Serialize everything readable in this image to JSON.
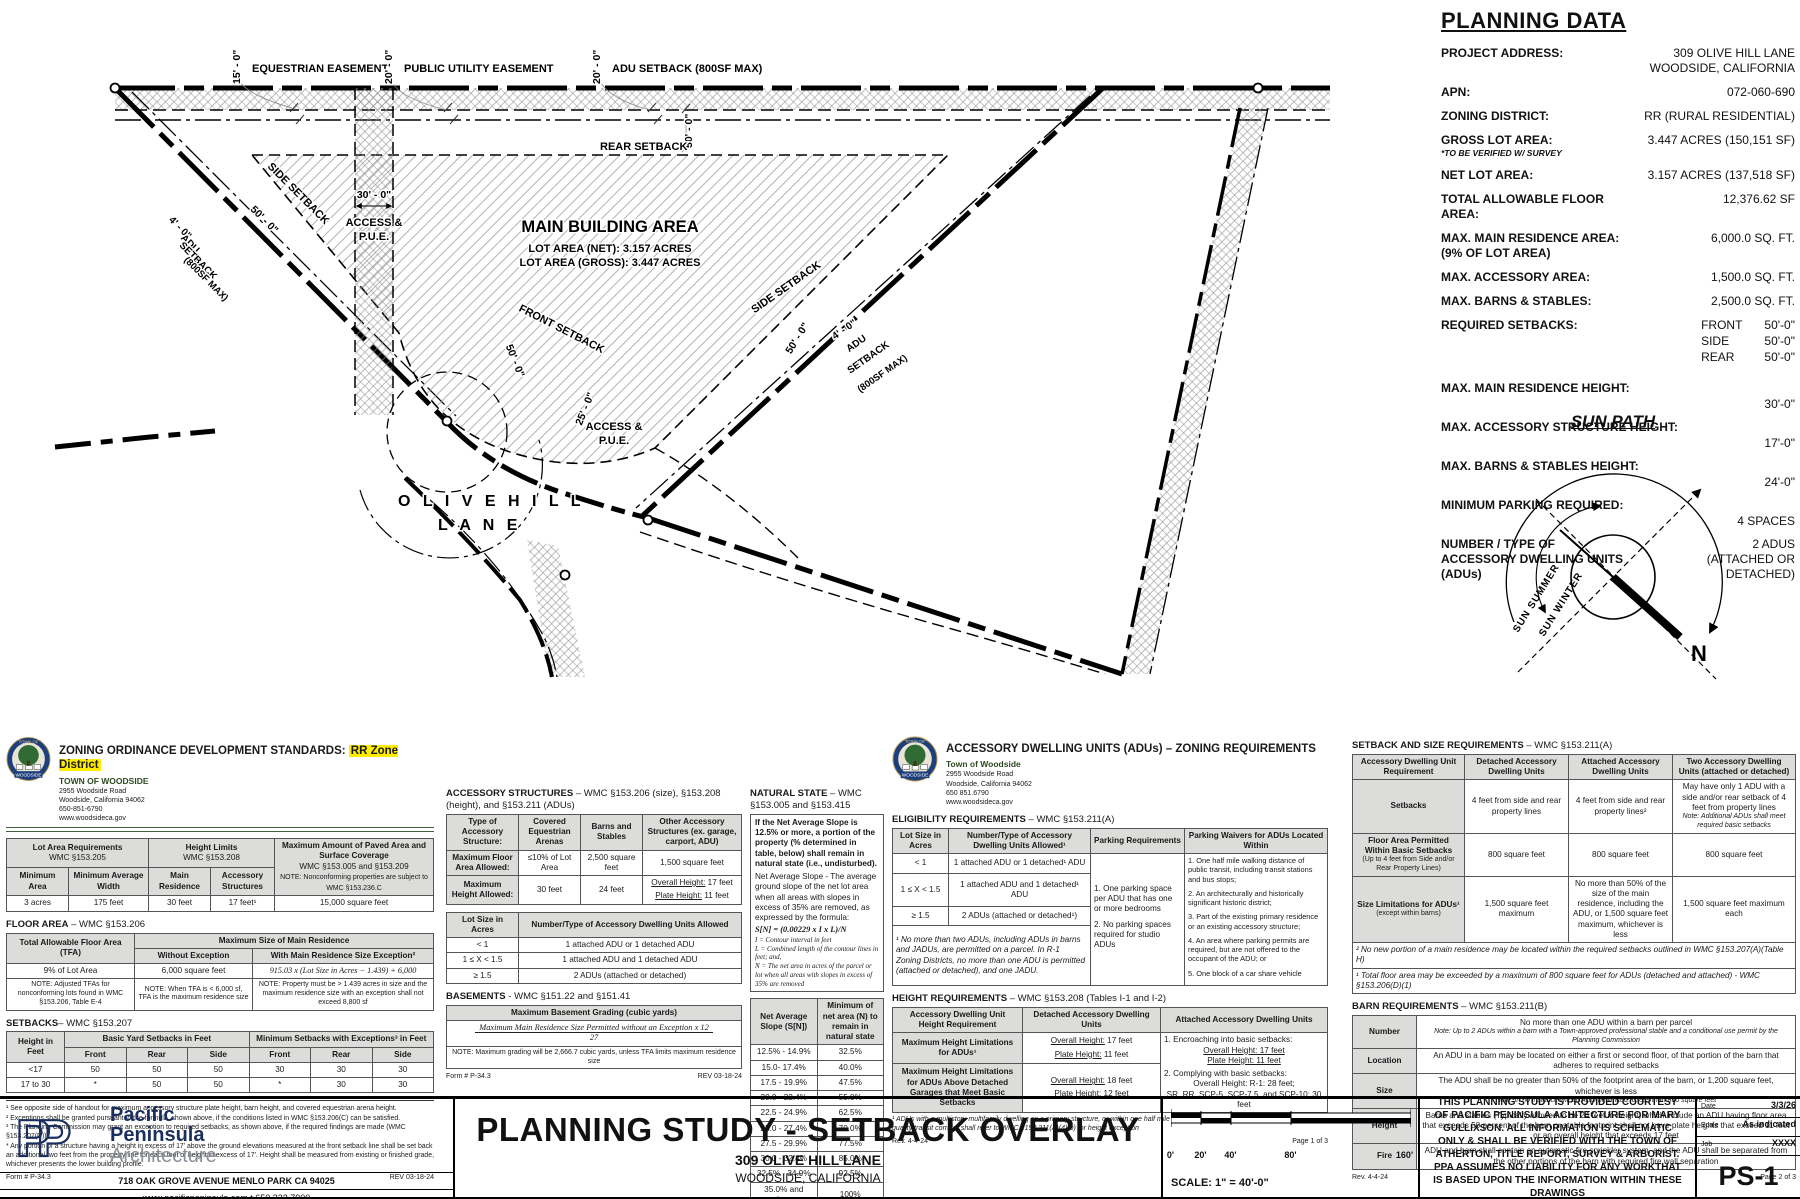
{
  "seal": {
    "top": "TOWN OF",
    "bottom": "WOODSIDE"
  },
  "plan": {
    "equestrian_easement": "EQUESTRIAN EASEMENT",
    "dim_15": "15' - 0\"",
    "public_utility_easement": "PUBLIC UTILITY EASEMENT",
    "dim_20_pue": "20' - 0\"",
    "adu_setback_top": "ADU SETBACK (800SF MAX)",
    "dim_20_adu": "20' - 0\"",
    "rear_setback": "REAR SETBACK",
    "dim_50_rear": "50' - 0\"",
    "side_setback_left": "SIDE SETBACK",
    "dim_50_side_left": "50' - 0\"",
    "adu_left_1": "4' - 0\"",
    "adu_left_2": "ADU",
    "adu_left_3": "SETBACK",
    "adu_left_4": "(800SF MAX)",
    "access_dim_30": "30' - 0\"",
    "access_1": "ACCESS &",
    "access_2": "P.U.E.",
    "main_area_title": "MAIN BUILDING AREA",
    "main_area_l1": "LOT AREA (NET): 3.157 ACRES",
    "main_area_l2": "LOT AREA (GROSS): 3.447 ACRES",
    "front_setback": "FRONT SETBACK",
    "dim_50_front": "50' - 0\"",
    "side_setback_right": "SIDE SETBACK",
    "dim_50_side_right": "50' - 0\"",
    "adu_right_1": "4' - 0\"",
    "adu_right_2": "ADU",
    "adu_right_3": "SETBACK",
    "adu_right_4": "(800SF MAX)",
    "access2_dim_25": "25' - 0\"",
    "access2_1": "ACCESS &",
    "access2_2": "P.U.E.",
    "road_1": "O L I V E   H I L L",
    "road_2": "L A N E"
  },
  "planning_data": {
    "title": "PLANNING DATA",
    "rows": [
      {
        "label": "PROJECT ADDRESS:",
        "value": "309 OLIVE HILL LANE\nWOODSIDE, CALIFORNIA"
      },
      {
        "label": "APN:",
        "value": "072-060-690"
      },
      {
        "label": "ZONING DISTRICT:",
        "value": "RR (RURAL RESIDENTIAL)"
      },
      {
        "label": "GROSS LOT AREA:",
        "note": "*TO BE VERIFIED W/ SURVEY",
        "value": "3.447 ACRES (150,151 SF)"
      },
      {
        "label": "NET LOT AREA:",
        "value": "3.157 ACRES (137,518 SF)"
      },
      {
        "label": "TOTAL ALLOWABLE FLOOR AREA:",
        "value": "12,376.62 SF"
      },
      {
        "label": "MAX. MAIN RESIDENCE AREA:\n(9% OF LOT AREA)",
        "value": "6,000.0 SQ. FT."
      },
      {
        "label": "MAX. ACCESSORY AREA:",
        "value": "1,500.0 SQ. FT."
      },
      {
        "label": "MAX. BARNS & STABLES:",
        "value": "2,500.0 SQ. FT."
      }
    ],
    "setbacks_label": "REQUIRED SETBACKS:",
    "setbacks": [
      {
        "k": "FRONT",
        "v": "50'-0\""
      },
      {
        "k": "SIDE",
        "v": "50'-0\""
      },
      {
        "k": "REAR",
        "v": "50'-0\""
      }
    ],
    "stacked_rows": [
      {
        "label": "MAX. MAIN RESIDENCE HEIGHT:",
        "value": "30'-0\""
      },
      {
        "label": "MAX. ACCESSORY STRUCTURE HEIGHT:",
        "value": "17'-0\""
      },
      {
        "label": "MAX. BARNS & STABLES HEIGHT:",
        "value": "24'-0\""
      },
      {
        "label": "MINIMUM PARKING REQUIRED:",
        "value": "4 SPACES"
      }
    ],
    "adu_label": "NUMBER / TYPE OF\nACCESSORY DWELLING UNITS (ADUs)",
    "adu_value": "2 ADUS\n(ATTACHED OR DETACHED)"
  },
  "sun_path": {
    "title": "SUN PATH",
    "summer": "SUN  SUMMER",
    "winter": "SUN  WINTER",
    "north": "N"
  },
  "panel1": {
    "title_prefix": "ZONING ORDINANCE DEVELOPMENT STANDARDS: ",
    "title_highlight": "RR Zone District",
    "town": {
      "name": "TOWN OF WOODSIDE",
      "addr1": "2955 Woodside Road",
      "addr2": "Woodside, California 94062",
      "phone": "650-851-6790",
      "web": "www.woodsideca.gov"
    },
    "t1": {
      "h_lot": "Lot Area Requirements",
      "h_lot_ref": "WMC §153.205",
      "h_height": "Height Limits",
      "h_height_ref": "WMC §153.208",
      "h_paved": "Maximum Amount of Paved Area and Surface Coverage",
      "h_paved_ref": "WMC §153.005 and §153.209",
      "h_paved_note": "NOTE: Nonconforming properties are subject to WMC §153.236.C",
      "c1": "Minimum Area",
      "c2": "Minimum Average Width",
      "c3": "Main Residence",
      "c4": "Accessory Structures",
      "v1": "3 acres",
      "v2": "175 feet",
      "v3": "30 feet",
      "v4": "17 feet¹",
      "v5": "15,000 square feet"
    },
    "floor_h": "FLOOR AREA",
    "floor_ref": " – WMC §153.206",
    "t2": {
      "c1": "Total Allowable Floor Area (TFA)",
      "h": "Maximum Size of Main Residence",
      "c2": "Without Exception",
      "c3": "With Main Residence Size Exception²",
      "v1": "9% of Lot Area",
      "v2": "6,000 square feet",
      "v3": "915.03 x (Lot Size in Acres − 1.439) + 6,000",
      "n1": "NOTE: Adjusted TFAs for nonconforming lots found in WMC §153.206, Table E-4",
      "n2": "NOTE: When TFA is < 6,000 sf, TFA is the maximum residence size",
      "n3": "NOTE: Property must be > 1.439 acres in size and the maximum residence size with an exception shall not exceed 8,800 sf"
    },
    "setb_h": "SETBACKS",
    "setb_ref": "– WMC §153.207",
    "t3": {
      "c1": "Height in Feet",
      "h1": "Basic Yard Setbacks in Feet",
      "h2": "Minimum Setbacks with Exceptions³ in Feet",
      "s1": "Front",
      "s2": "Rear",
      "s3": "Side",
      "s4": "Front",
      "s5": "Rear",
      "s6": "Side",
      "rows": [
        [
          "<17",
          "50",
          "50",
          "50",
          "30",
          "30",
          "30"
        ],
        [
          "17 to 30",
          "*",
          "50",
          "50",
          "*",
          "30",
          "30"
        ]
      ]
    },
    "footnotes": [
      "¹ See opposite side of handout for maximum accessory structure plate height, barn height, and covered equestrian arena height.",
      "² Exceptions shall be granted pursuant to the formula, shown above, if the conditions listed in WMC §153.206(C) can be satisfied.",
      "³ The Planning Commission may grant an exception to required setbacks, as shown above, if the required findings are made (WMC §153.207(D)).",
      "* Any portion of a structure having a height in excess of 17' above the ground elevations measured at the front setback line shall be set back an additional two feet from the property line for each foot of height in excess of 17'. Height shall be measured from existing or finished grade, whichever presents the lower building profile."
    ],
    "form": "Form # P-34.3",
    "rev": "REV 03-18-24"
  },
  "panel2": {
    "acc_h": "ACCESSORY STRUCTURES",
    "acc_ref": "– WMC §153.206 (size), §153.208 (height), and §153.211 (ADUs)",
    "t1": {
      "c0": "Type of Accessory Structure:",
      "c1": "Covered Equestrian Arenas",
      "c2": "Barns and Stables",
      "c3": "Other Accessory Structures (ex. garage, carport, ADU)",
      "r1l": "Maximum Floor Area Allowed:",
      "r1v1": "≤10% of Lot Area",
      "r1v2": "2,500 square feet",
      "r1v3": "1,500 square feet",
      "r2l": "Maximum Height Allowed:",
      "r2v1": "30 feet",
      "r2v2": "24 feet",
      "oh_k": "Overall Height:",
      "oh_v": " 17 feet",
      "ph_k": "Plate Height:",
      "ph_v": " 11 feet"
    },
    "t2": {
      "h1": "Lot Size in Acres",
      "h2": "Number/Type of Accessory Dwelling Units Allowed",
      "rows": [
        [
          "< 1",
          "1 attached ADU or 1 detached ADU"
        ],
        [
          "1 ≤ X < 1.5",
          "1 attached ADU and 1 detached ADU"
        ],
        [
          "≥ 1.5",
          "2 ADUs (attached or detached)"
        ]
      ]
    },
    "bas_h": "BASEMENTS",
    "bas_ref": " - WMC §151.22 and §151.41",
    "bas_th": "Maximum Basement Grading (cubic yards)",
    "bas_num": "Maximum Main Residence Size Permitted without an Exception x 12",
    "bas_den": "27",
    "bas_note": "NOTE: Maximum grading will be 2,666.7 cubic yards, unless TFA limits maximum residence size",
    "nat_h": "NATURAL STATE",
    "nat_ref": " – WMC §153.005 and §153.415",
    "nat_box": "If the Net Average Slope is 12.5% or more, a portion of the property (% determined in table, below) shall remain in natural state (i.e., undisturbed).",
    "nat_p1": "Net Average Slope - The average ground slope of the net lot area when all areas with slopes in excess of 35% are removed, as expressed by the formula:",
    "nat_formula": "S[N] = (0.00229 x I x L)/N",
    "nat_i": "I = Contour interval in feet",
    "nat_l": "L = Combined length of the contour lines in feet; and,",
    "nat_n": "N = The net area in acres of the parcel or lot when all areas with slopes in excess of 35% are removed",
    "nat_th1": "Net Average Slope (S[N])",
    "nat_th2": "Minimum of net area (N) to remain in natural state",
    "nat_rows": [
      [
        "12.5% - 14.9%",
        "32.5%"
      ],
      [
        "15.0- 17.4%",
        "40.0%"
      ],
      [
        "17.5 - 19.9%",
        "47.5%"
      ],
      [
        "20.0 - 22.4%",
        "55.0%"
      ],
      [
        "22.5 - 24.9%",
        "62.5%"
      ],
      [
        "25.0 - 27.4%",
        "70.0%"
      ],
      [
        "27.5 - 29.9%",
        "77.5%"
      ],
      [
        "30.0 - 32.4%",
        "85.0%"
      ],
      [
        "32.5% - 34.9%",
        "92.5%"
      ],
      [
        "35.0% and above",
        "100%"
      ]
    ],
    "form": "Form # P-34.3",
    "rev": "REV 03-18-24"
  },
  "panel3": {
    "title": "ACCESSORY DWELLING UNITS (ADUs) – ZONING REQUIREMENTS",
    "town": {
      "name": "Town of Woodside",
      "addr1": "2955 Woodside Road",
      "addr2": "Woodside, California 94062",
      "phone": "650 851.6790",
      "web": "www.woodsideca.gov"
    },
    "elig_h": "ELIGIBILITY REQUIREMENTS",
    "elig_ref": " – WMC §153.211(A)",
    "t1": {
      "h1": "Lot Size in Acres",
      "h2": "Number/Type of Accessory Dwelling Units Allowed¹",
      "h3": "Parking Requirements",
      "h4": "Parking Waivers for ADUs Located Within",
      "rows": [
        [
          "< 1",
          "1 attached ADU or 1 detached¹ ADU"
        ],
        [
          "1 ≤ X < 1.5",
          "1 attached ADU and 1 detached¹ ADU"
        ],
        [
          "≥ 1.5",
          "2 ADUs (attached or detached¹)"
        ]
      ],
      "parking": [
        "1.   One parking space per ADU that has one or more bedrooms",
        "2.   No parking spaces required for studio ADUs"
      ],
      "waivers": [
        "1.   One half mile walking distance of public transit, including transit stations and bus stops;",
        "2.   An architecturally and historically significant historic district;",
        "3.   Part of the existing primary residence or an existing accessory structure;",
        "4.   An area where parking permits are required, but are not offered to the occupant of the ADU; or",
        "5.   One block of a car share vehicle"
      ],
      "footnote": "¹ No more than two ADUs, including ADUs in barns and JADUs, are permitted on a parcel. In R-1 Zoning Districts, no more than one ADU is permitted (attached or detached), and one JADU."
    },
    "h_h": "HEIGHT REQUIREMENTS",
    "h_ref": " – WMC §153.208 (Tables I-1 and I-2)",
    "t2": {
      "h1": "Accessory Dwelling Unit Height Requirement",
      "h2": "Detached Accessory Dwelling Units",
      "h3": "Attached Accessory Dwelling Units",
      "r1l": "Maximum Height Limitations for ADUs¹",
      "r1a_k": "Overall Height:",
      "r1a_v": " 17 feet",
      "r1b_k": "Plate Height:",
      "r1b_v": " 11 feet",
      "r2l": "Maximum Height Limitations for ADUs Above Detached Garages that Meet Basic Setbacks",
      "r2a_k": "Overall Height:",
      "r2a_v": " 18 feet",
      "r2b_k": "Plate Height:",
      "r2b_v": " 12 feet",
      "att": [
        "1.   Encroaching into basic setbacks:",
        "Overall Height: 17 feet",
        "Plate Height: 11 feet",
        "2.   Complying with basic setbacks:",
        "Overall Height: R-1: 28 feet;",
        "SR, RR, SCP-5, SCP-7.5, and SCP-10: 30 feet"
      ],
      "footnote": "¹ ADUs with a multistory multifamily dwelling as a primary structure, or within one half mile walking distance of major transit stop or high-quality transit corridor shall refer to WMC §153.211(A)(4)(b) for height exception"
    },
    "rev": "Rev. 4-4-24",
    "page": "Page 1 of 3"
  },
  "panel4": {
    "t1_h": "SETBACK AND SIZE REQUIREMENTS",
    "t1_ref": " – WMC §153.211(A)",
    "t1": {
      "h1": "Accessory Dwelling Unit Requirement",
      "h2": "Detached Accessory Dwelling Units",
      "h3": "Attached Accessory Dwelling Units",
      "h4": "Two Accessory Dwelling Units (attached or detached)",
      "r1l": "Setbacks",
      "r1a": "4 feet from side and rear property lines",
      "r1b": "4 feet from side and rear property lines²",
      "r1c": "May have only 1 ADU with a side and/or rear setback of 4 feet from property lines",
      "r1c_note": "Note: Additional ADUs shall meet required basic setbacks",
      "r2l": "Floor Area Permitted Within Basic Setbacks",
      "r2l_sub": "(Up to 4 feet from Side and/or Rear Property Lines)",
      "r2a": "800 square feet",
      "r2b": "800 square feet",
      "r2c": "800 square feet",
      "r3l": "Size Limitations for ADUs¹",
      "r3l_sub": "(except within barns)",
      "r3a": "1,500 square feet maximum",
      "r3b": "No more than 50% of the size of the main residence, including the ADU, or 1,500 square feet maximum, whichever is less",
      "r3c": "1,500 square feet maximum each",
      "fn1": "² No new portion of a main residence may be located within the required setbacks outlined in WMC §153.207(A)(Table H)",
      "fn2": "¹ Total floor area may be exceeded by a maximum of 800 square feet for ADUs (detached and attached) - WMC §153.206(D)(1)"
    },
    "t2_h": "BARN REQUIREMENTS",
    "t2_ref": " – WMC §153.211(B)",
    "t2": {
      "rows": [
        {
          "label": "Number",
          "text": "No more than one ADU within a barn per parcel",
          "note": "Note: Up to 2 ADUs within a barn with a Town-approved professional stable and a conditional use permit by the Planning Commission"
        },
        {
          "label": "Location",
          "text": "An ADU in a barn may be located on either a first or second floor, of that portion of the barn that adheres to required setbacks",
          "note": ""
        },
        {
          "label": "Size",
          "text": "The ADU shall be no greater than 50% of the footprint area of the barn, or 1,200 square feet, whichever is less",
          "note": "Note: In no instance will an ADU be limited to less than 850 square feet"
        },
        {
          "label": "Height",
          "text": "Barns and stables (Typically allowed to be 24 feet in height) which include an ADU having floor area that exceeds 50 percent of the barn or stable footprint shall not have plate heights that exceed 11 feet or an overall height that exceeds 17 feet",
          "note": ""
        },
        {
          "label": "Fire",
          "text": "ADU and barn shall contain an automatic fire sprinkler system, and the ADU shall be separated from the other portions of the barn with required fire wall separation",
          "note": ""
        }
      ]
    },
    "rev": "Rev. 4-4-24",
    "page": "Page 2 of 3"
  },
  "title_block": {
    "firm": {
      "logo": "PP",
      "line1": "Pacific",
      "line2": "Peninsula",
      "line3": "Architecture",
      "addr": "718 OAK GROVE AVENUE  MENLO PARK CA 94025",
      "contact": "www.pacificpeninsula.com   t 650.323.7900"
    },
    "title": "PLANNING STUDY - SETBACK OVERLAY",
    "sub1": "309 OLIVE HILL LANE",
    "sub2": "WOODSIDE, CALIFORNIA",
    "scale_ticks": [
      "0'",
      "20'",
      "40'",
      "80'",
      "160'"
    ],
    "scale_label": "SCALE: 1\" = 40'-0\"",
    "disclaimer": "THIS PLANNING STUDY IS PROVIDED COURTESY OF PACIFIC PENINSULA ACHITECTURE FOR MARY GULLIXSON. ALL INFORMATION IS SCHEMATIC ONLY & SHALL BE VERIFIED WITH THE TOWN OF ATHERTON, TITLE REPORT, SURVEY & ARBORIST. PPA ASSUMES NO LIABILITY FOR ANY WORKTHAT IS BASED UPON THE INFORMATION WITHIN THESE DRAWINGS",
    "meta": [
      {
        "label": "Date",
        "value": "3/3/26"
      },
      {
        "label": "Scale",
        "value": "As indicated"
      },
      {
        "label": "Job",
        "value": "XXXX"
      }
    ],
    "sheet": "PS-1"
  }
}
